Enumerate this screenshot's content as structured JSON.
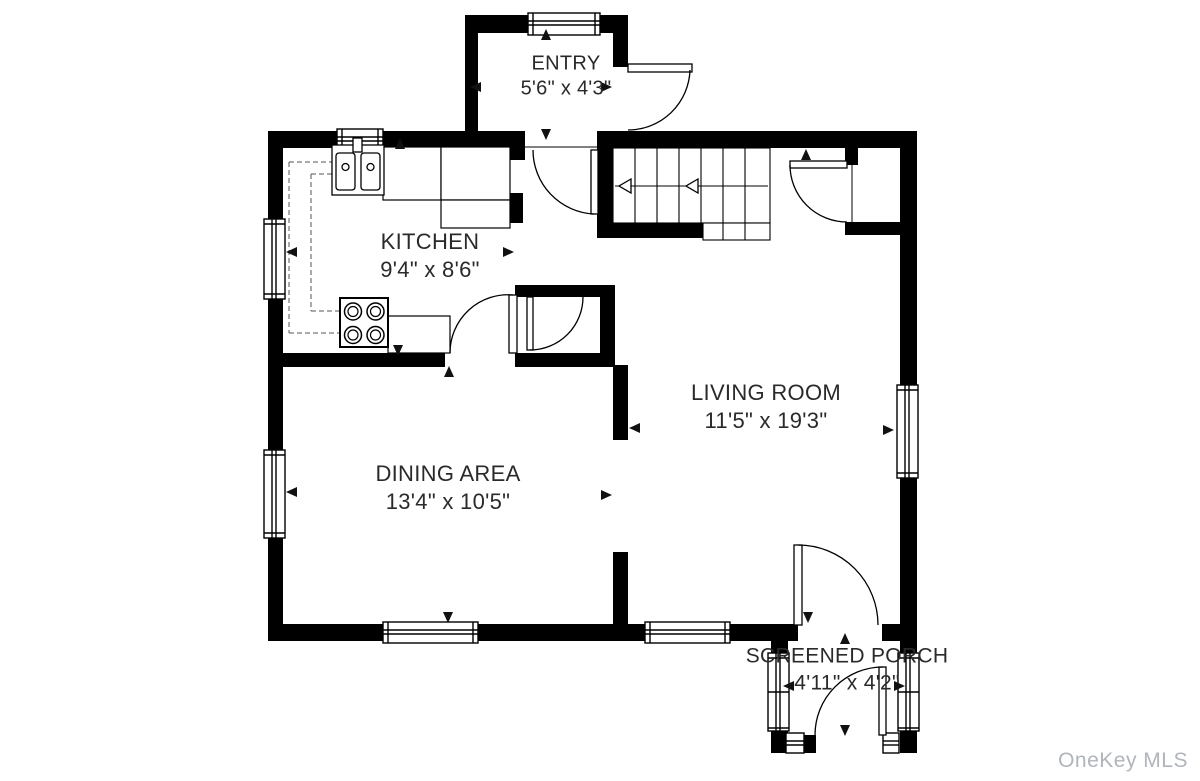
{
  "rooms": {
    "entry": {
      "name": "ENTRY",
      "dims": "5'6\" x 4'3\""
    },
    "kitchen": {
      "name": "KITCHEN",
      "dims": "9'4\" x 8'6\""
    },
    "dining": {
      "name": "DINING AREA",
      "dims": "13'4\" x 10'5\""
    },
    "living": {
      "name": "LIVING ROOM",
      "dims": "11'5\" x 19'3\""
    },
    "porch": {
      "name": "SCREENED PORCH",
      "dims": "4'11\" x 4'2\""
    }
  },
  "watermark": "OneKey MLS",
  "colors": {
    "wall": "#000000",
    "label": "#2a2a2a",
    "watermark": "#b0b5bc",
    "background": "#ffffff"
  }
}
